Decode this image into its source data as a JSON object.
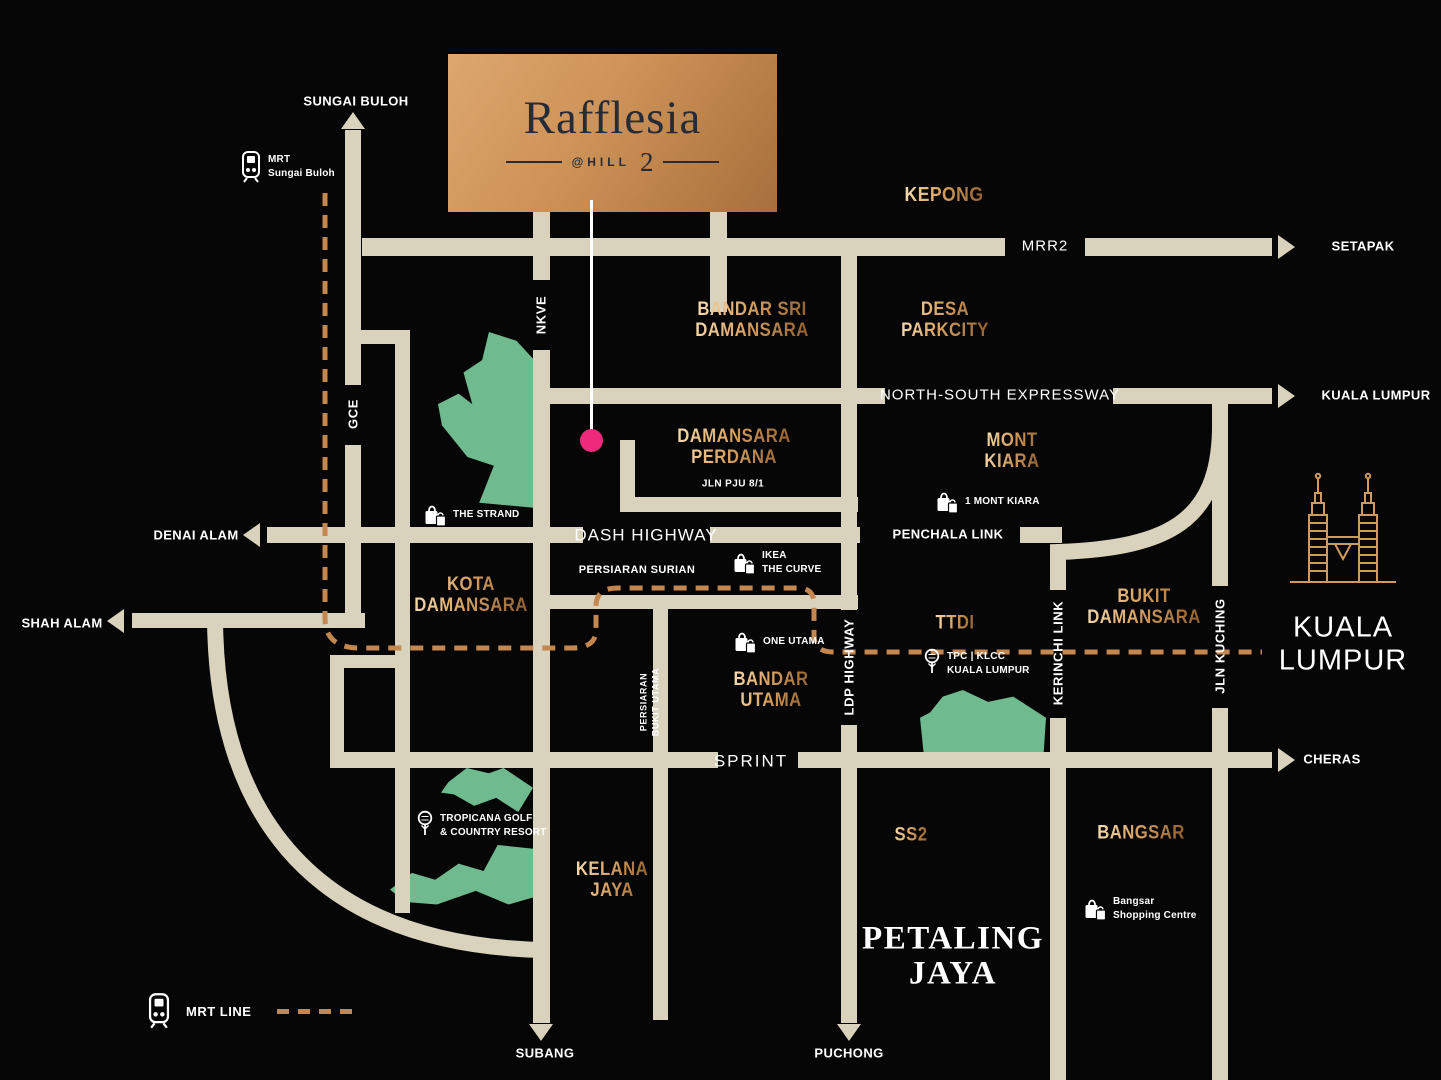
{
  "colors": {
    "bg": "#060606",
    "road": "#d9d2bc",
    "green": "#6fba8e",
    "mrt": "#c4874f",
    "marker": "#ee2a7b",
    "ink": "#262b38",
    "gold_hi": "#f7ddb0",
    "gold_md": "#d8a263",
    "gold_lo": "#8f5c2c"
  },
  "logo": {
    "title": "Rafflesia",
    "sub": "@HILL",
    "sub_number": "2"
  },
  "legend": {
    "label": "MRT LINE"
  },
  "edges": [
    {
      "label": "SUNGAI BULOH",
      "dir": "up"
    },
    {
      "label": "SETAPAK",
      "dir": "right"
    },
    {
      "label": "KUALA LUMPUR",
      "dir": "right"
    },
    {
      "label": "DENAI ALAM",
      "dir": "left"
    },
    {
      "label": "SHAH ALAM",
      "dir": "left"
    },
    {
      "label": "CHERAS",
      "dir": "right"
    },
    {
      "label": "SUBANG",
      "dir": "down"
    },
    {
      "label": "PUCHONG",
      "dir": "down"
    }
  ],
  "regions": [
    {
      "label": "KEPONG"
    },
    {
      "label": "BANDAR SRI\nDAMANSARA"
    },
    {
      "label": "DESA\nPARKCITY"
    },
    {
      "label": "DAMANSARA\nPERDANA"
    },
    {
      "label": "MONT\nKIARA"
    },
    {
      "label": "KOTA\nDAMANSARA"
    },
    {
      "label": "TTDI"
    },
    {
      "label": "BUKIT\nDAMANSARA"
    },
    {
      "label": "BANDAR\nUTAMA"
    },
    {
      "label": "KELANA\nJAYA"
    },
    {
      "label": "SS2"
    },
    {
      "label": "BANGSAR"
    }
  ],
  "cities": [
    {
      "label": "PETALING\nJAYA"
    },
    {
      "label": "KUALA\nLUMPUR"
    }
  ],
  "road_labels": {
    "mrr2": "MRR2",
    "nse": "NORTH-SOUTH EXPRESSWAY",
    "dash": "DASH HIGHWAY",
    "penchala": "PENCHALA LINK",
    "surian": "PERSIARAN SURIAN",
    "pju": "JLN PJU 8/1",
    "sprint": "SPRINT",
    "nkve": "NKVE",
    "gce": "GCE",
    "ldp": "LDP HIGHWAY",
    "kerinchi": "KERINCHI LINK",
    "kuching": "JLN KUCHING",
    "pbu": "PERSIARAN\nBUKIT UTAMA"
  },
  "pois": [
    {
      "icon": "train-icon",
      "label": "MRT\nSungai Buloh"
    },
    {
      "icon": "shopping-bag-icon",
      "label": "THE STRAND"
    },
    {
      "icon": "shopping-bag-icon",
      "label": "IKEA\nTHE CURVE"
    },
    {
      "icon": "shopping-bag-icon",
      "label": "1 MONT KIARA"
    },
    {
      "icon": "shopping-bag-icon",
      "label": "ONE UTAMA"
    },
    {
      "icon": "golf-icon",
      "label": "TPC | KLCC\nKUALA LUMPUR"
    },
    {
      "icon": "golf-icon",
      "label": "TROPICANA GOLF\n& COUNTRY RESORT"
    },
    {
      "icon": "shopping-bag-icon",
      "label": "Bangsar\nShopping Centre"
    }
  ]
}
